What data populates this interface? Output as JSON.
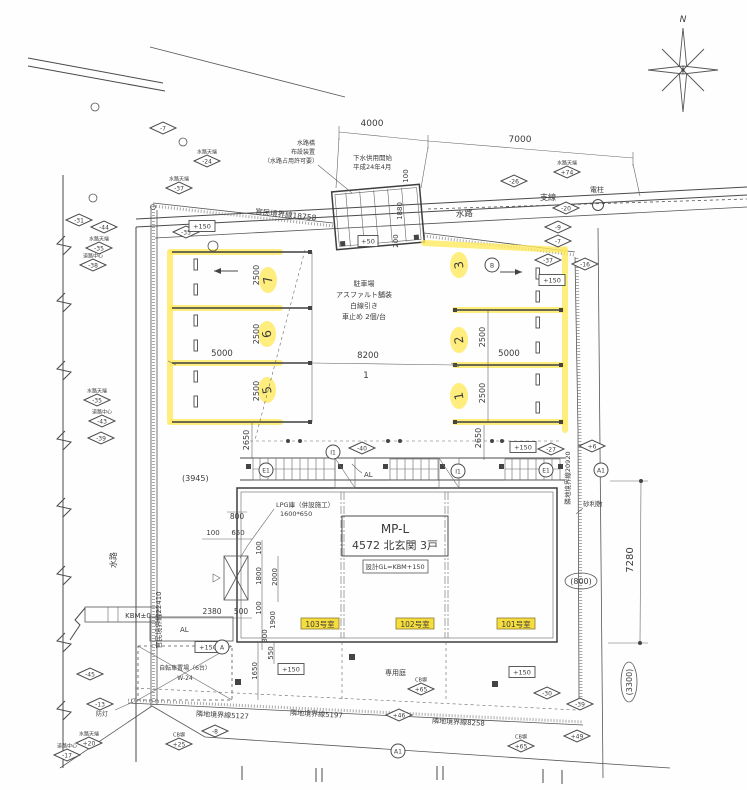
{
  "compass": {
    "n": "N"
  },
  "notes": {
    "bridge1": "水路橋",
    "bridge2": "布設装置",
    "bridge3": "（水路占用許可要）",
    "sewer1": "下水供用開始",
    "sewer2": "平成24年4月",
    "waterway_top": "水路",
    "waterway_left": "水路",
    "branch": "支線",
    "pole": "電柱",
    "park1": "駐車場",
    "park2": "アスファルト舗装",
    "park3": "白線引き",
    "park4": "車止め 2個/台",
    "gravel": "砂利敷",
    "garden": "専用庭",
    "bike1": "自転車置場（6台）",
    "bike2": "W-24",
    "lpg1": "LPG庫（併設施工）",
    "lpg2": "1600*650",
    "kbm": "KBM±0",
    "light": "防灯",
    "al_w": "AL",
    "al_n": "AL"
  },
  "boundaries": {
    "top": "官民境界線18758",
    "left": "官民境界線22410",
    "right": "隣地境界線20920",
    "b1": "隣地境界線5127",
    "b2": "隣地境界線5197",
    "b3": "隣地境界線8258"
  },
  "building": {
    "model": "MP-L",
    "subtitle": "4572 北玄関 3戸",
    "gl": "設計GL=KBM+150",
    "rooms": [
      "103号室",
      "102号室",
      "101号室"
    ]
  },
  "parking": {
    "stalls": [
      "7",
      "6",
      "5",
      "3",
      "2",
      "1"
    ],
    "lane_no": "1"
  },
  "dims": {
    "t4000": "4000",
    "t7000": "7000",
    "b100": "100",
    "b1880": "1880",
    "b200": "200",
    "l5000": "5000",
    "r5000": "5000",
    "lane8200": "8200",
    "l2500a": "2500",
    "l2500b": "2500",
    "l2500c": "2500",
    "r2500a": "2500",
    "r2500b": "2500",
    "l2650": "2650",
    "r2650": "2650",
    "off3945": "(3945)",
    "w800": "800",
    "w100a": "100",
    "w650": "650",
    "w100b": "100",
    "w1800": "1800",
    "w2000": "2000",
    "w100c": "100",
    "w1900": "1900",
    "w300": "300",
    "w2380": "2380",
    "w500": "500",
    "w550": "550",
    "w1650": "1650",
    "e7280": "7280",
    "e800": "(800)",
    "e3300": "(3300)"
  },
  "markers": [
    {
      "x": 163,
      "y": 128,
      "value": "-7"
    },
    {
      "x": 207,
      "y": 161,
      "value": "-24",
      "caption": "水路天端"
    },
    {
      "x": 179,
      "y": 188,
      "value": "-37",
      "caption": "水路天端"
    },
    {
      "x": 79,
      "y": 220,
      "value": "-31"
    },
    {
      "x": 104,
      "y": 227,
      "value": "-44"
    },
    {
      "x": 99,
      "y": 248,
      "value": "-35",
      "caption": "水路天端"
    },
    {
      "x": 93,
      "y": 265,
      "value": "-38",
      "caption": "道路中心"
    },
    {
      "x": 186,
      "y": 232,
      "value": "-35"
    },
    {
      "x": 97,
      "y": 400,
      "value": "-35",
      "caption": "水路天端"
    },
    {
      "x": 102,
      "y": 421,
      "value": "-43",
      "caption": "道路中心"
    },
    {
      "x": 101,
      "y": 438,
      "value": "-39"
    },
    {
      "x": 567,
      "y": 172,
      "value": "+74",
      "caption": "水路天端"
    },
    {
      "x": 514,
      "y": 181,
      "value": "-26"
    },
    {
      "x": 566,
      "y": 208,
      "value": "-20"
    },
    {
      "x": 558,
      "y": 227,
      "value": "-9"
    },
    {
      "x": 558,
      "y": 241,
      "value": "-7"
    },
    {
      "x": 548,
      "y": 260,
      "value": "-37"
    },
    {
      "x": 585,
      "y": 264,
      "value": "-16"
    },
    {
      "x": 592,
      "y": 446,
      "value": "+6"
    },
    {
      "x": 551,
      "y": 449,
      "value": "-27"
    },
    {
      "x": 362,
      "y": 448,
      "value": "-40"
    },
    {
      "x": 90,
      "y": 674,
      "value": "-45"
    },
    {
      "x": 100,
      "y": 704,
      "value": "-13"
    },
    {
      "x": 89,
      "y": 743,
      "value": "+20",
      "caption": "水路天端"
    },
    {
      "x": 67,
      "y": 755,
      "value": "-17",
      "caption": "道路中心"
    },
    {
      "x": 215,
      "y": 731,
      "value": "-8"
    },
    {
      "x": 179,
      "y": 744,
      "value": "+25",
      "caption": "CB塀"
    },
    {
      "x": 421,
      "y": 689,
      "value": "+65",
      "caption": "CB塀"
    },
    {
      "x": 399,
      "y": 715,
      "value": "+46"
    },
    {
      "x": 547,
      "y": 693,
      "value": "-30"
    },
    {
      "x": 580,
      "y": 704,
      "value": "-39"
    },
    {
      "x": 577,
      "y": 736,
      "value": "+49"
    },
    {
      "x": 521,
      "y": 746,
      "value": "+65",
      "caption": "CB塀"
    }
  ],
  "gl_marks": [
    {
      "x": 202,
      "y": 226,
      "label": "+150"
    },
    {
      "x": 552,
      "y": 280,
      "label": "+150"
    },
    {
      "x": 523,
      "y": 447,
      "label": "+150"
    },
    {
      "x": 208,
      "y": 647,
      "label": "+150"
    },
    {
      "x": 291,
      "y": 669,
      "label": "+150"
    },
    {
      "x": 522,
      "y": 672,
      "label": "+150"
    },
    {
      "x": 368,
      "y": 241,
      "label": "+50"
    }
  ],
  "refs": [
    {
      "x": 266,
      "y": 470,
      "label": "E1"
    },
    {
      "x": 333,
      "y": 452,
      "label": "I1"
    },
    {
      "x": 458,
      "y": 471,
      "label": "I1"
    },
    {
      "x": 546,
      "y": 470,
      "label": "E1"
    },
    {
      "x": 222,
      "y": 647,
      "label": "A"
    },
    {
      "x": 601,
      "y": 470,
      "label": "A1"
    },
    {
      "x": 398,
      "y": 751,
      "label": "A1"
    },
    {
      "x": 492,
      "y": 265,
      "label": "B"
    }
  ]
}
